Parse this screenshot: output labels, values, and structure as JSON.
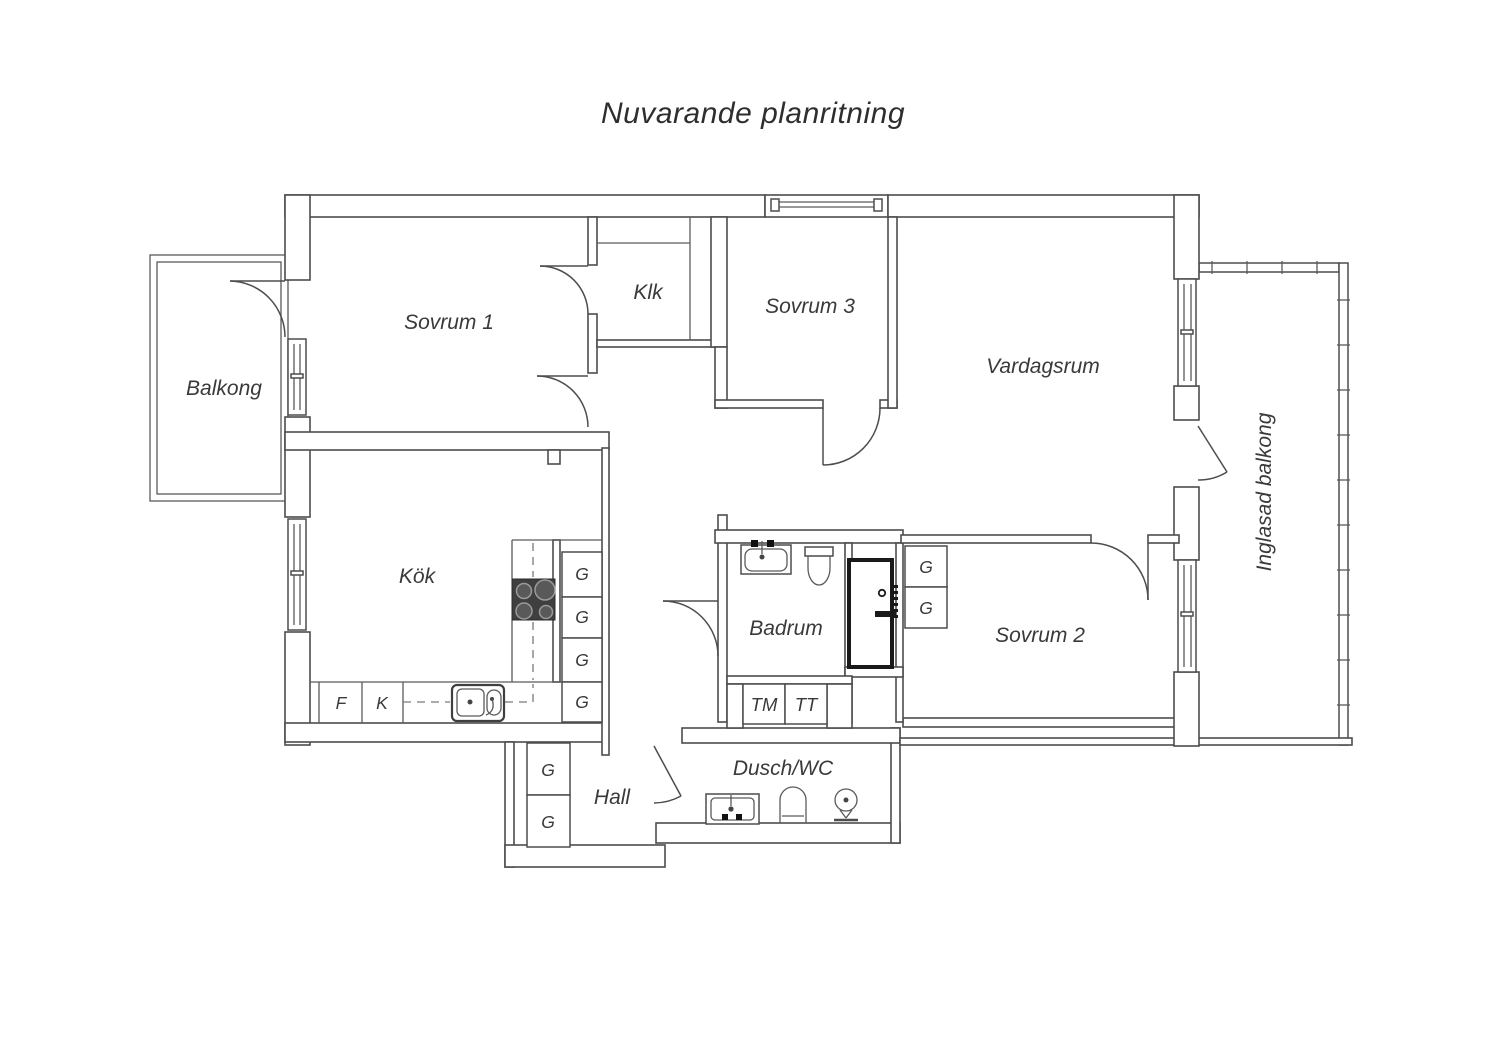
{
  "title": "Nuvarande planritning",
  "rooms": {
    "balkong": "Balkong",
    "sovrum1": "Sovrum 1",
    "klk": "Klk",
    "sovrum3": "Sovrum 3",
    "vardagsrum": "Vardagsrum",
    "inglasad_balkong": "Inglasad balkong",
    "kok": "Kök",
    "badrum": "Badrum",
    "sovrum2": "Sovrum 2",
    "hall": "Hall",
    "dusch_wc": "Dusch/WC"
  },
  "cabinets": {
    "wardrobe": "G",
    "fridge": "F",
    "freezer": "K",
    "washing_machine": "TM",
    "tumble_dryer": "TT"
  },
  "colors": {
    "line": "#4d4d4d",
    "text": "#3a3a3a",
    "appliance_dark": "#3f3f3f",
    "background": "#ffffff"
  }
}
